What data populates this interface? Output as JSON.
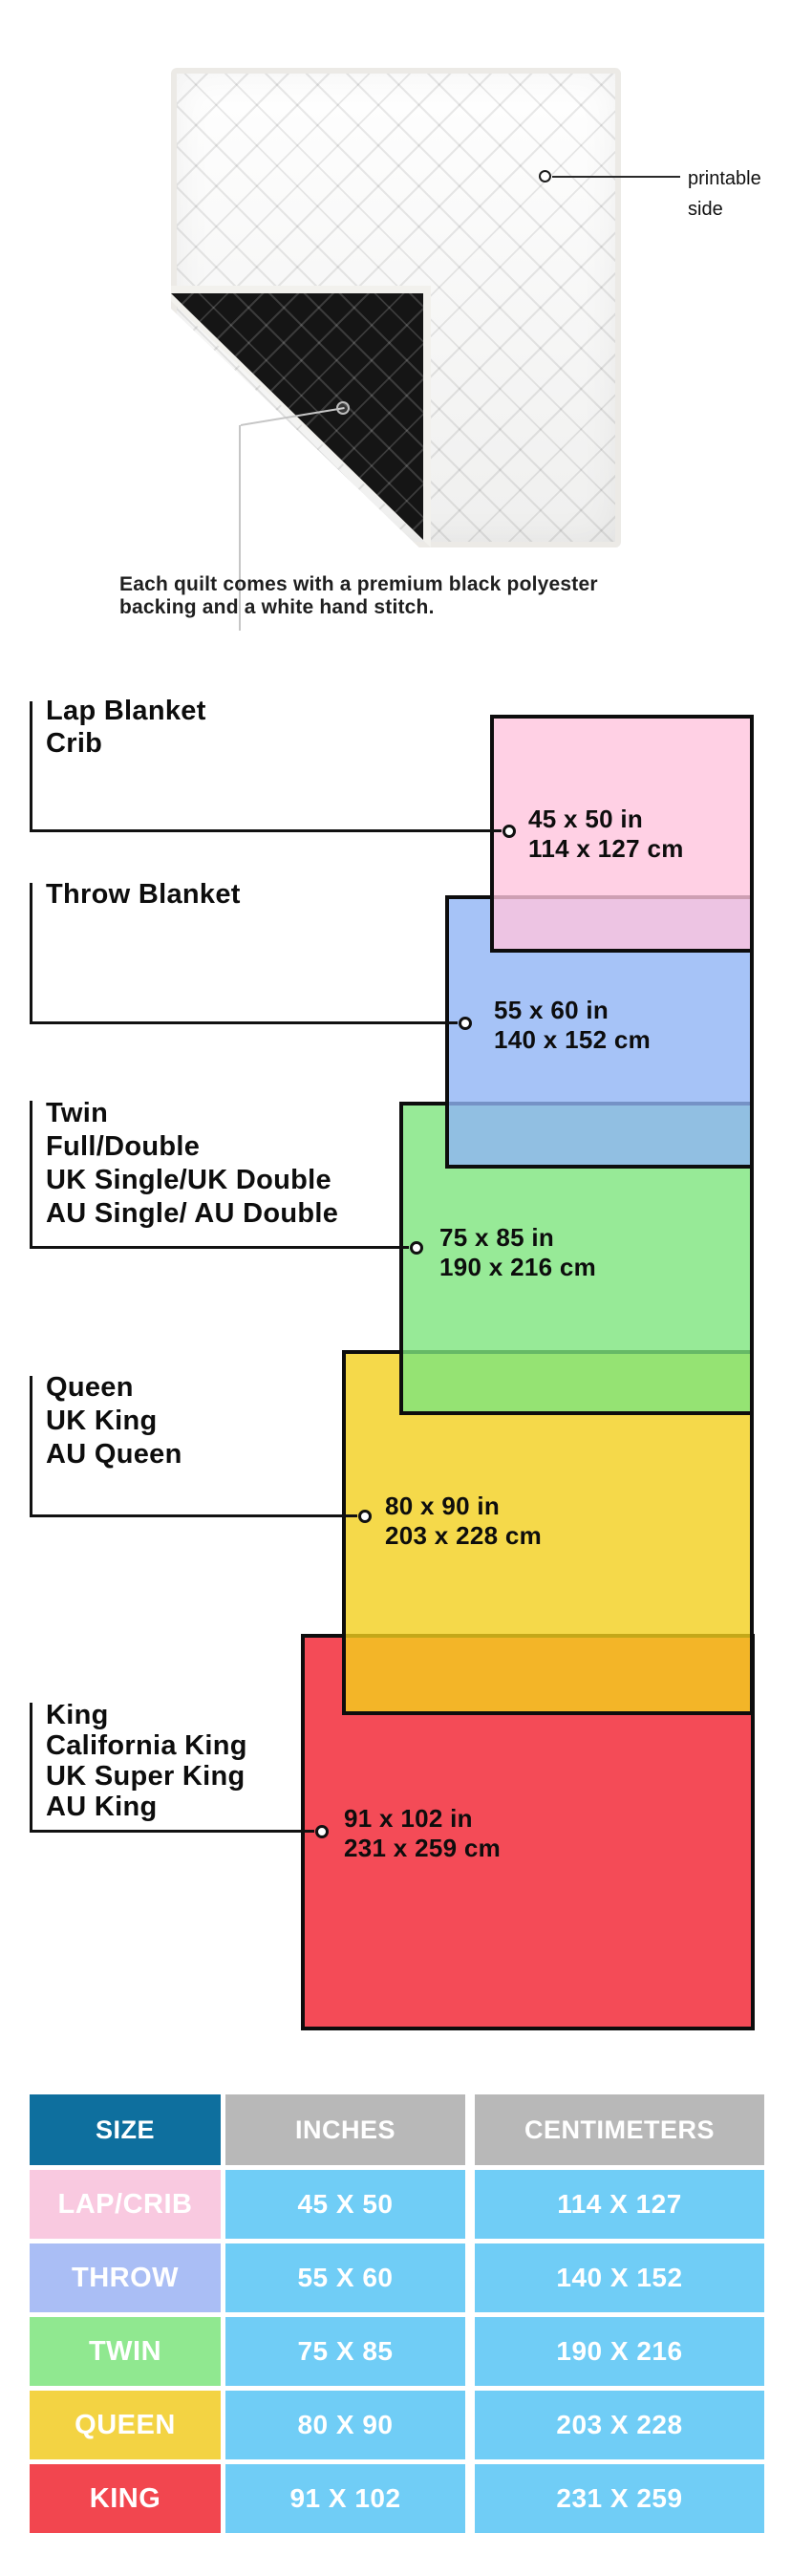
{
  "hero": {
    "printable_label_line1": "printable",
    "printable_label_line2": "side",
    "caption_line1": "Each quilt comes with a premium black polyester",
    "caption_line2": "backing and a white hand stitch."
  },
  "diagram": {
    "groups": [
      {
        "id": "lap",
        "title_lines": [
          "Lap Blanket",
          "Crib"
        ],
        "inches": "45 x 50 in",
        "cm": "114 x 127 cm",
        "fill": "rgba(255,196,221,0.8)"
      },
      {
        "id": "throw",
        "title_lines": [
          "Throw Blanket"
        ],
        "inches": "55 x 60 in",
        "cm": "140 x 152 cm",
        "fill": "rgba(144,180,245,0.8)"
      },
      {
        "id": "twin",
        "title_lines": [
          "Twin",
          "Full/Double",
          "UK Single/UK Double",
          "AU Single/ AU Double"
        ],
        "inches": "75 x 85 in",
        "cm": "190 x 216 cm",
        "fill": "rgba(125,229,125,0.8)"
      },
      {
        "id": "queen",
        "title_lines": [
          "Queen",
          "UK King",
          "AU Queen"
        ],
        "inches": "80 x 90 in",
        "cm": "203 x 228 cm",
        "fill": "rgba(243,208,29,0.8)"
      },
      {
        "id": "king",
        "title_lines": [
          "King",
          "California King",
          "UK Super King",
          "AU King"
        ],
        "inches": "91 x 102 in",
        "cm": "231 x 259 cm",
        "fill": "rgba(241,30,45,0.8)"
      }
    ]
  },
  "table": {
    "headers": [
      "SIZE",
      "INCHES",
      "CENTIMETERS"
    ],
    "header_size_bg": "#0e6f9e",
    "header_other_bg": "#b8b8b8",
    "cell_bg": "#70cdf6",
    "rows": [
      {
        "size": "LAP/CRIB",
        "inches": "45 X 50",
        "cm": "114 X 127",
        "color": "#f9c9e0"
      },
      {
        "size": "THROW",
        "inches": "55 X 60",
        "cm": "140 X 152",
        "color": "#aabef5"
      },
      {
        "size": "TWIN",
        "inches": "75 X 85",
        "cm": "190 X 216",
        "color": "#90e890"
      },
      {
        "size": "QUEEN",
        "inches": "80 X 90",
        "cm": "203 X 228",
        "color": "#f3d343"
      },
      {
        "size": "KING",
        "inches": "91 X 102",
        "cm": "231 X 259",
        "color": "#f2464f"
      }
    ]
  }
}
